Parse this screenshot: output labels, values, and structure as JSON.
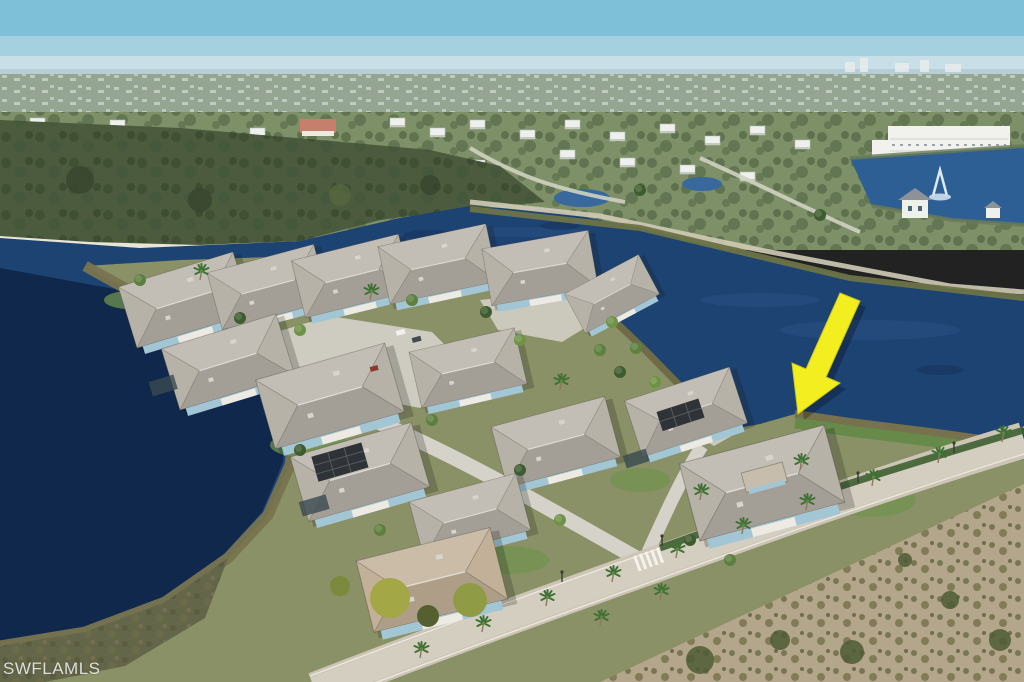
{
  "meta": {
    "type": "aerial-photograph",
    "description": "Drone aerial view of a Florida lakefront home community; a yellow arrow marks a waterfront house lot beside a navy-blue lake, with preserve woods, a main road and distant neighborhoods."
  },
  "watermark": {
    "text": "SWFLAMLS"
  },
  "annotation": {
    "arrow": "yellow-highlight-arrow"
  },
  "colors": {
    "sky_top": "#7ec0d8",
    "sky_mid": "#a5d0e0",
    "sky_horizon": "#c9dfe7",
    "haze": "#b8cdd4",
    "far_band": "#8c9b82",
    "mid_band": "#7d9068",
    "forest": "#4c5a3e",
    "sand": "#e9e5d6",
    "lake_main": "#1d4373",
    "lake_dark": "#0d2344",
    "lake_small": "#2d5f95",
    "shore_scrub": "#78744e",
    "berm": "#d0cab6",
    "grass_bank": "#678a4b",
    "land_base": "#8b9166",
    "marsh": "#64664a",
    "lawn": "#70934f",
    "pavement": "#d5d2ca",
    "road": "#ccc5b6",
    "road_light": "#d4cec1",
    "roof_gray": "#b7b2a8",
    "roof_tan": "#c2b098",
    "roof_dark": "#2f3338",
    "wall_blue": "#a3c6d4",
    "building_white": "#f1f2ee",
    "pink_roof": "#c77f6d",
    "arrow_yellow": "#f2ee1f",
    "tree_dark": "#3f5c30",
    "tree_mid": "#5d7f3f",
    "tree_light": "#6f9346",
    "autumn": "#a3a746",
    "scrub_sand": "#b3a68a",
    "watermark": "rgba(255,255,255,0.8)"
  }
}
